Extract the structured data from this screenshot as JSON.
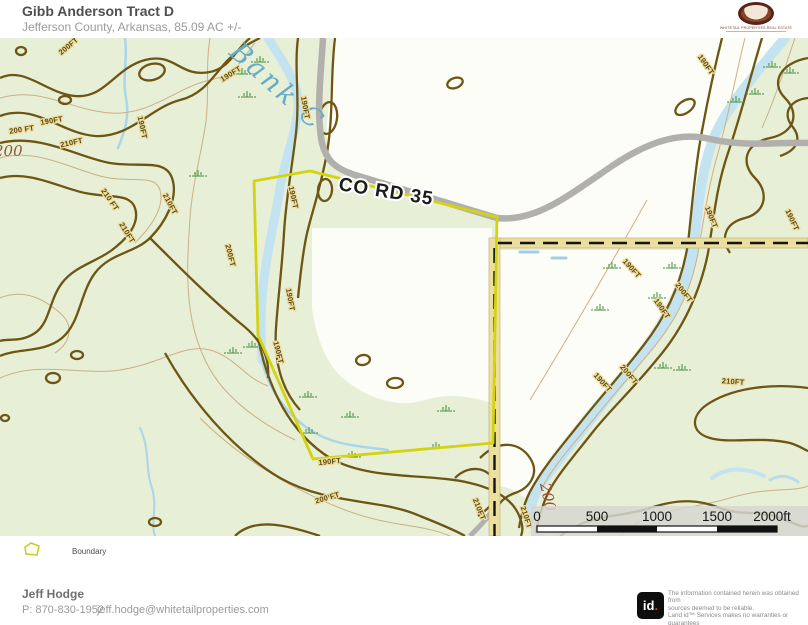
{
  "header": {
    "title": "Gibb Anderson Tract D",
    "subtitle": "Jefferson County, Arkansas, 85.09 AC +/-"
  },
  "brand": {
    "logo_text": "WHITETAIL PROPERTIES REAL ESTATE"
  },
  "map": {
    "labels": {
      "creek": "Bank C",
      "road": "CO RD 35",
      "elevation_left": "200",
      "elevation_right": "200"
    },
    "contour_labels": [
      {
        "t": "200FT",
        "x": 70,
        "y": 10,
        "r": -40
      },
      {
        "t": "190FT",
        "x": 232,
        "y": 38,
        "r": -32
      },
      {
        "t": "190FT",
        "x": 52,
        "y": 85,
        "r": -10
      },
      {
        "t": "200 FT",
        "x": 22,
        "y": 94,
        "r": -8
      },
      {
        "t": "210FT",
        "x": 72,
        "y": 107,
        "r": -12
      },
      {
        "t": "190FT",
        "x": 140,
        "y": 90,
        "r": 78
      },
      {
        "t": "210 FT",
        "x": 108,
        "y": 163,
        "r": 55
      },
      {
        "t": "210FT",
        "x": 168,
        "y": 167,
        "r": 62
      },
      {
        "t": "210FT",
        "x": 125,
        "y": 196,
        "r": 58
      },
      {
        "t": "190FT",
        "x": 303,
        "y": 70,
        "r": 80
      },
      {
        "t": "190FT",
        "x": 291,
        "y": 160,
        "r": 78
      },
      {
        "t": "200FT",
        "x": 228,
        "y": 218,
        "r": 76
      },
      {
        "t": "190FT",
        "x": 288,
        "y": 262,
        "r": 80
      },
      {
        "t": "190FT",
        "x": 276,
        "y": 315,
        "r": 76
      },
      {
        "t": "190FT",
        "x": 330,
        "y": 426,
        "r": -6
      },
      {
        "t": "200 FT",
        "x": 328,
        "y": 462,
        "r": -16
      },
      {
        "t": "210FT",
        "x": 477,
        "y": 472,
        "r": 68
      },
      {
        "t": "210FT",
        "x": 524,
        "y": 480,
        "r": 72
      },
      {
        "t": "190FT",
        "x": 704,
        "y": 28,
        "r": 55
      },
      {
        "t": "190FT",
        "x": 709,
        "y": 180,
        "r": 68
      },
      {
        "t": "190FT",
        "x": 790,
        "y": 183,
        "r": 65
      },
      {
        "t": "190FT",
        "x": 630,
        "y": 232,
        "r": 48
      },
      {
        "t": "200FT",
        "x": 682,
        "y": 256,
        "r": 52
      },
      {
        "t": "190FT",
        "x": 660,
        "y": 272,
        "r": 55
      },
      {
        "t": "190FT",
        "x": 601,
        "y": 346,
        "r": 48
      },
      {
        "t": "200FT",
        "x": 627,
        "y": 338,
        "r": 50
      },
      {
        "t": "210FT",
        "x": 733,
        "y": 346,
        "r": 4
      }
    ],
    "swamp_marks": [
      [
        242,
        34
      ],
      [
        260,
        22
      ],
      [
        247,
        57
      ],
      [
        198,
        136
      ],
      [
        233,
        313
      ],
      [
        252,
        307
      ],
      [
        308,
        357
      ],
      [
        350,
        377
      ],
      [
        446,
        371
      ],
      [
        309,
        393
      ],
      [
        352,
        417
      ],
      [
        663,
        328
      ],
      [
        682,
        330
      ],
      [
        672,
        228
      ],
      [
        657,
        258
      ],
      [
        612,
        228
      ],
      [
        755,
        54
      ],
      [
        772,
        27
      ],
      [
        790,
        33
      ],
      [
        736,
        62
      ],
      [
        600,
        270
      ],
      [
        436,
        408
      ]
    ],
    "scalebar": {
      "ticks": [
        {
          "label": "0",
          "x": 537
        },
        {
          "label": "500",
          "x": 597
        },
        {
          "label": "1000",
          "x": 657
        },
        {
          "label": "1500",
          "x": 717
        },
        {
          "label": "2000ft",
          "x": 772
        }
      ]
    },
    "colors": {
      "background_green": "#e7efd6",
      "open_white": "#fdfdf8",
      "water": "#c3e3f1",
      "index_contour": "#6d5513",
      "intermediate_contour": "#cbb086",
      "boundary_yellow": "#d3d312",
      "county_road_tan": "#ecdf9e",
      "gray_road": "#b2b0ad"
    }
  },
  "legend": {
    "items": [
      {
        "label": "Boundary"
      }
    ]
  },
  "footer": {
    "agent_name": "Jeff Hodge",
    "agent_phone": "P: 870-830-1952",
    "agent_email": "jeff.hodge@whitetailproperties.com"
  },
  "attribution": {
    "logo_id": "id",
    "logo_dot": ".",
    "disclaimer_lines": [
      "The information contained herein was obtained from",
      "sources deemed to be reliable.",
      " Land id™ Services makes no warranties or guarantees",
      "as to the completeness or accuracy thereof."
    ]
  }
}
